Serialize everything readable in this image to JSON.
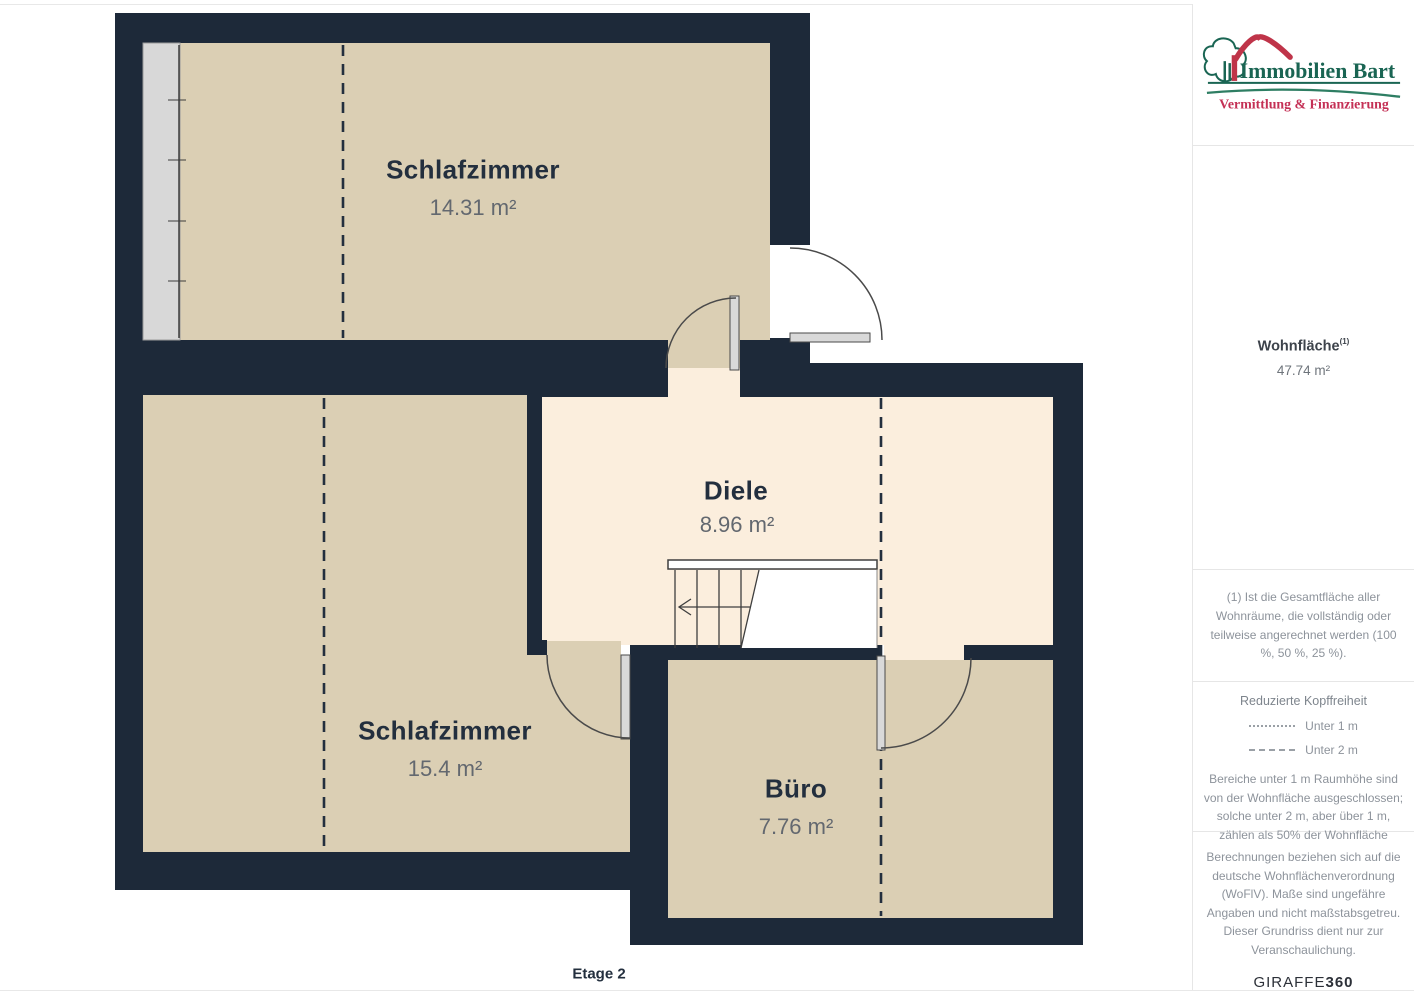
{
  "plan": {
    "floor_label": "Etage 2",
    "rooms": [
      {
        "name": "Schlafzimmer",
        "area": "14.31 m²"
      },
      {
        "name": "Schlafzimmer",
        "area": "15.4 m²"
      },
      {
        "name": "Diele",
        "area": "8.96 m²"
      },
      {
        "name": "Büro",
        "area": "7.76 m²"
      }
    ]
  },
  "sidebar": {
    "logo": {
      "title": "Immobilien Bart",
      "subtitle": "Vermittlung & Finanzierung"
    },
    "living_area": {
      "label": "Wohnfläche",
      "sup": "(1)",
      "value": "47.74 m²"
    },
    "footnote": "(1) Ist die Gesamtfläche aller Wohnräume, die vollständig oder teilweise angerechnet werden (100 %, 50 %, 25 %).",
    "headroom": {
      "title": "Reduzierte Kopffreiheit",
      "legend": [
        {
          "style": "dotted",
          "label": "Unter 1 m"
        },
        {
          "style": "dashed",
          "label": "Unter 2 m"
        }
      ],
      "note": "Bereiche unter 1 m Raumhöhe sind von der Wohnfläche ausgeschlossen; solche unter 2 m, aber über 1 m, zählen als 50% der Wohnfläche"
    },
    "disclaimer": "Berechnungen beziehen sich auf die deutsche Wohnflächenverordnung (WoFlV). Maße sind ungefähre Angaben und nicht maßstabsgetreu. Dieser Grundriss dient nur zur Veranschaulichung.",
    "brand": {
      "name": "GIRAFFE",
      "suffix": "360"
    }
  },
  "colors": {
    "wall": "#1d2939",
    "room_beige": "#dbcfb4",
    "hall_peach": "#fbeedd",
    "logo_green": "#1a6553",
    "logo_red": "#bf3449",
    "subtitle_red": "#c43055",
    "label_dark": "#232f3e",
    "label_gray": "#63686f",
    "sidebar_gray": "#8d939b"
  }
}
